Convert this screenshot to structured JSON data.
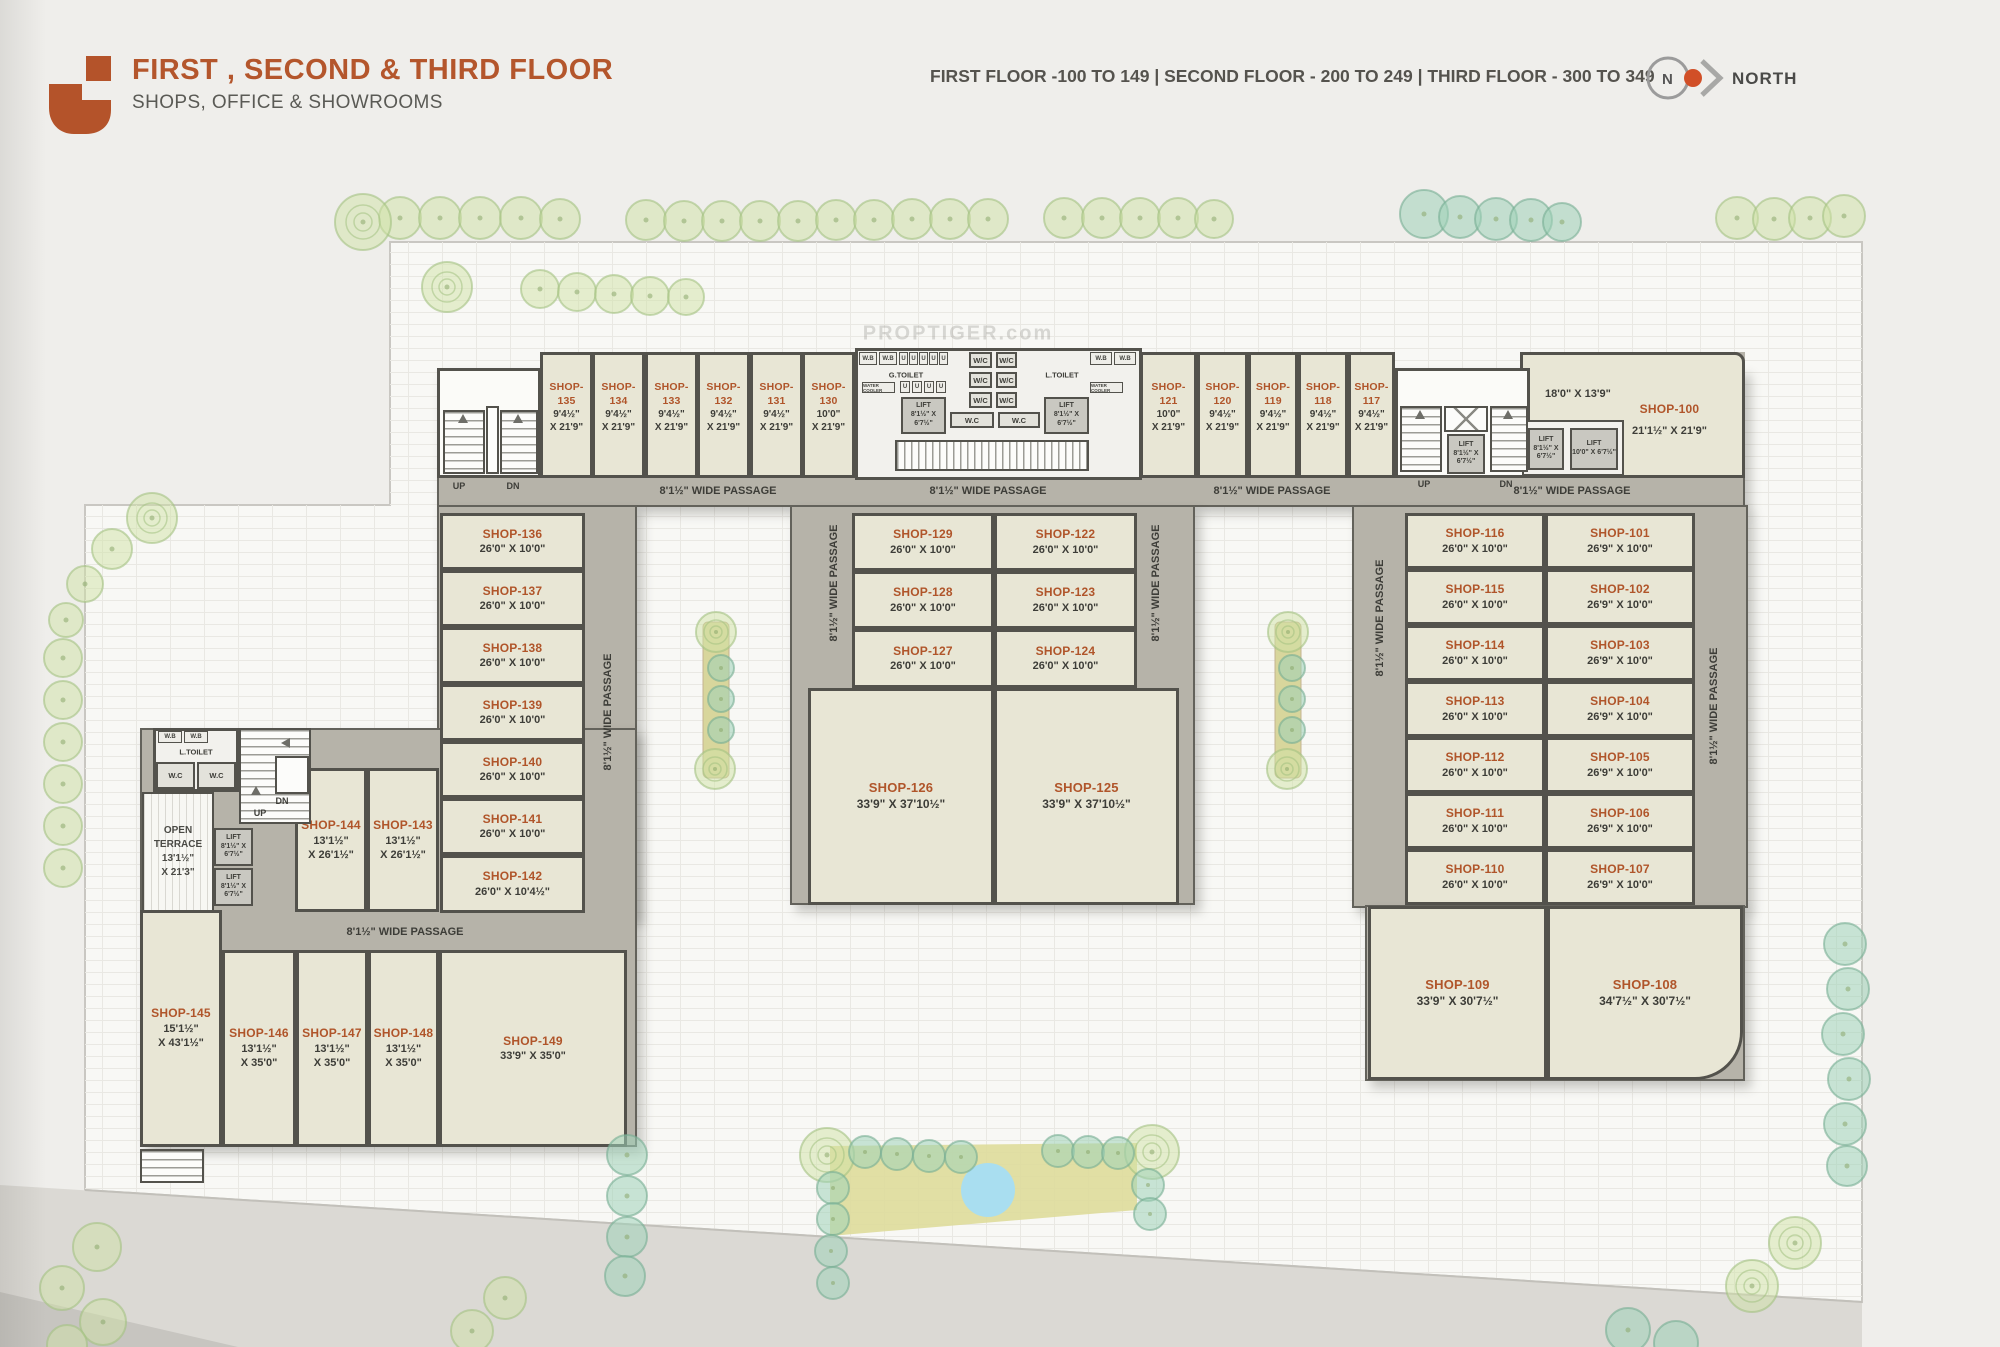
{
  "header": {
    "title": "FIRST , SECOND & THIRD FLOOR",
    "subtitle": "SHOPS, OFFICE & SHOWROOMS",
    "floor_info": "FIRST FLOOR -100 TO 149  |  SECOND FLOOR - 200 TO 249  |  THIRD FLOOR - 300 TO 349",
    "north": {
      "letter": "N",
      "label": "NORTH"
    },
    "accent_color": "#b4562c"
  },
  "labels": {
    "passage": "8'1½\" WIDE PASSAGE",
    "up": "UP",
    "dn": "DN",
    "g_toilet": "G.TOILET",
    "l_toilet": "L.TOILET",
    "wc": "W/C",
    "wc_dot": "W.C",
    "wb": "W.B",
    "u": "U",
    "water_cooler": "WATER COOLER",
    "watermark": "PROPTIGER.com",
    "terrace": {
      "l1": "OPEN",
      "l2": "TERRACE",
      "d1": "13'1½\"",
      "d2": "X 21'3\""
    },
    "lift": {
      "name": "LIFT",
      "a": "8'1½\" X",
      "b": "6'7½\"",
      "wide": "10'0\" X 6'7½\""
    }
  },
  "shops": {
    "s100": {
      "id": "SHOP-100",
      "d1": "21'1½\" X 21'9\"",
      "inner": "18'0\" X 13'9\""
    },
    "s101": {
      "id": "SHOP-101",
      "d1": "26'9\" X 10'0\""
    },
    "s102": {
      "id": "SHOP-102",
      "d1": "26'9\" X 10'0\""
    },
    "s103": {
      "id": "SHOP-103",
      "d1": "26'9\" X 10'0\""
    },
    "s104": {
      "id": "SHOP-104",
      "d1": "26'9\" X 10'0\""
    },
    "s105": {
      "id": "SHOP-105",
      "d1": "26'9\" X 10'0\""
    },
    "s106": {
      "id": "SHOP-106",
      "d1": "26'9\" X 10'0\""
    },
    "s107": {
      "id": "SHOP-107",
      "d1": "26'9\" X 10'0\""
    },
    "s108": {
      "id": "SHOP-108",
      "d1": "34'7½\" X 30'7½\""
    },
    "s109": {
      "id": "SHOP-109",
      "d1": "33'9\" X 30'7½\""
    },
    "s110": {
      "id": "SHOP-110",
      "d1": "26'0\" X 10'0\""
    },
    "s111": {
      "id": "SHOP-111",
      "d1": "26'0\" X 10'0\""
    },
    "s112": {
      "id": "SHOP-112",
      "d1": "26'0\" X 10'0\""
    },
    "s113": {
      "id": "SHOP-113",
      "d1": "26'0\" X 10'0\""
    },
    "s114": {
      "id": "SHOP-114",
      "d1": "26'0\" X 10'0\""
    },
    "s115": {
      "id": "SHOP-115",
      "d1": "26'0\" X 10'0\""
    },
    "s116": {
      "id": "SHOP-116",
      "d1": "26'0\" X 10'0\""
    },
    "s117": {
      "id": "SHOP-117",
      "d1": "9'4½\"",
      "d2": "X 21'9\""
    },
    "s118": {
      "id": "SHOP-118",
      "d1": "9'4½\"",
      "d2": "X 21'9\""
    },
    "s119": {
      "id": "SHOP-119",
      "d1": "9'4½\"",
      "d2": "X 21'9\""
    },
    "s120": {
      "id": "SHOP-120",
      "d1": "9'4½\"",
      "d2": "X 21'9\""
    },
    "s121": {
      "id": "SHOP-121",
      "d1": "10'0\"",
      "d2": "X 21'9\""
    },
    "s122": {
      "id": "SHOP-122",
      "d1": "26'0\" X 10'0\""
    },
    "s123": {
      "id": "SHOP-123",
      "d1": "26'0\" X 10'0\""
    },
    "s124": {
      "id": "SHOP-124",
      "d1": "26'0\" X 10'0\""
    },
    "s125": {
      "id": "SHOP-125",
      "d1": "33'9\" X 37'10½\""
    },
    "s126": {
      "id": "SHOP-126",
      "d1": "33'9\" X 37'10½\""
    },
    "s127": {
      "id": "SHOP-127",
      "d1": "26'0\" X 10'0\""
    },
    "s128": {
      "id": "SHOP-128",
      "d1": "26'0\" X 10'0\""
    },
    "s129": {
      "id": "SHOP-129",
      "d1": "26'0\" X 10'0\""
    },
    "s130": {
      "id": "SHOP-130",
      "d1": "10'0\"",
      "d2": "X 21'9\""
    },
    "s131": {
      "id": "SHOP-131",
      "d1": "9'4½\"",
      "d2": "X 21'9\""
    },
    "s132": {
      "id": "SHOP-132",
      "d1": "9'4½\"",
      "d2": "X 21'9\""
    },
    "s133": {
      "id": "SHOP-133",
      "d1": "9'4½\"",
      "d2": "X 21'9\""
    },
    "s134": {
      "id": "SHOP-134",
      "d1": "9'4½\"",
      "d2": "X 21'9\""
    },
    "s135": {
      "id": "SHOP-135",
      "d1": "9'4½\"",
      "d2": "X 21'9\""
    },
    "s136": {
      "id": "SHOP-136",
      "d1": "26'0\" X 10'0\""
    },
    "s137": {
      "id": "SHOP-137",
      "d1": "26'0\" X 10'0\""
    },
    "s138": {
      "id": "SHOP-138",
      "d1": "26'0\" X 10'0\""
    },
    "s139": {
      "id": "SHOP-139",
      "d1": "26'0\" X 10'0\""
    },
    "s140": {
      "id": "SHOP-140",
      "d1": "26'0\" X 10'0\""
    },
    "s141": {
      "id": "SHOP-141",
      "d1": "26'0\" X 10'0\""
    },
    "s142": {
      "id": "SHOP-142",
      "d1": "26'0\" X 10'4½\""
    },
    "s143": {
      "id": "SHOP-143",
      "d1": "13'1½\"",
      "d2": "X 26'1½\""
    },
    "s144": {
      "id": "SHOP-144",
      "d1": "13'1½\"",
      "d2": "X 26'1½\""
    },
    "s145": {
      "id": "SHOP-145",
      "d1": "15'1½\"",
      "d2": "X 43'1½\""
    },
    "s146": {
      "id": "SHOP-146",
      "d1": "13'1½\"",
      "d2": "X 35'0\""
    },
    "s147": {
      "id": "SHOP-147",
      "d1": "13'1½\"",
      "d2": "X 35'0\""
    },
    "s148": {
      "id": "SHOP-148",
      "d1": "13'1½\"",
      "d2": "X 35'0\""
    },
    "s149": {
      "id": "SHOP-149",
      "d1": "33'9\" X 35'0\""
    }
  }
}
